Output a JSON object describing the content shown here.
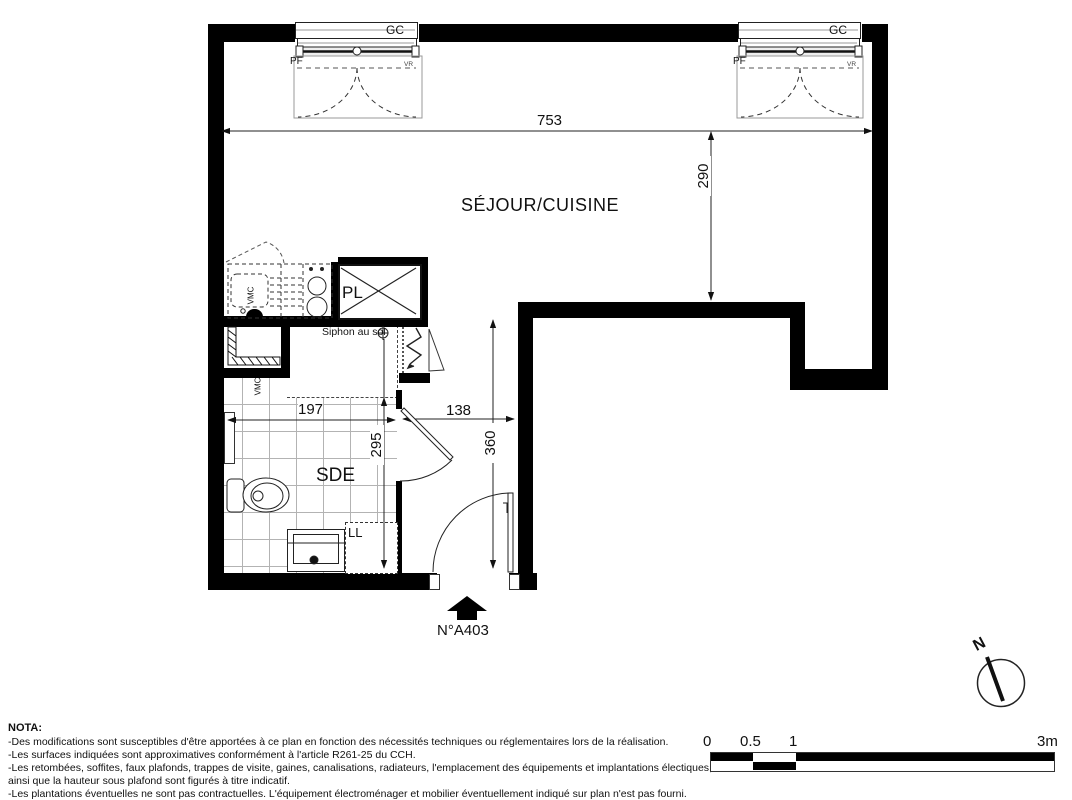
{
  "plan": {
    "room_main": "SÉJOUR/CUISINE",
    "room_sde": "SDE",
    "closet": "PL",
    "washer": "LL",
    "floor_drain": "Siphon au sol",
    "vent": "VMC",
    "unit_number": "N°A403",
    "north": "N",
    "window": {
      "gc": "GC",
      "pf": "PF",
      "vr": "VR"
    },
    "dims": {
      "sejour_width": "753",
      "sejour_depth": "290",
      "sde_width": "197",
      "sde_depth": "295",
      "hall_width": "138",
      "hall_depth": "360"
    }
  },
  "nota": {
    "title": "NOTA:",
    "lines": [
      "-Des modifications sont susceptibles d'être apportées à ce plan en fonction des nécessités techniques ou réglementaires lors de la réalisation.",
      "-Les surfaces indiquées sont approximatives conformément à l'article R261-25 du CCH.",
      "-Les retombées, soffites, faux plafonds, trappes de visite, gaines, canalisations, radiateurs, l'emplacement des équipements et implantations électiques,",
      "ainsi que la hauteur sous plafond sont figurés à titre indicatif.",
      "-Les plantations éventuelles ne sont pas contractuelles. L'équipement électroménager et mobilier éventuellement indiqué sur plan n'est pas fourni."
    ]
  },
  "scale_bar": {
    "labels": [
      "0",
      "0.5",
      "1",
      "3m"
    ]
  }
}
